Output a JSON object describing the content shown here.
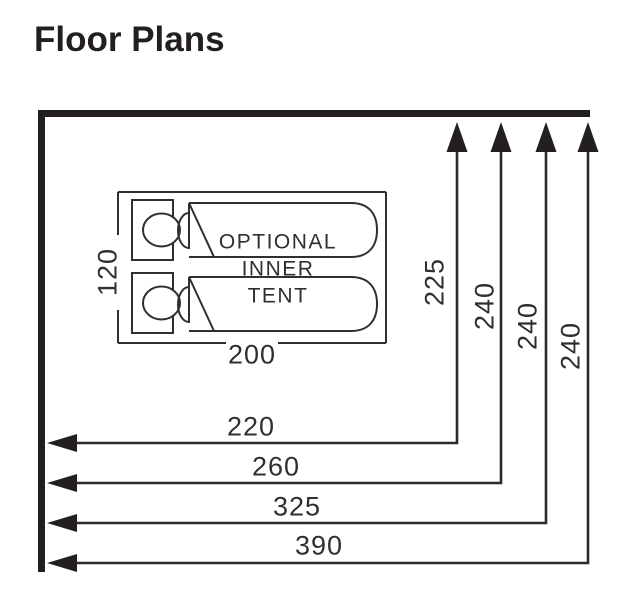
{
  "title": "Floor Plans",
  "colors": {
    "ink": "#231f20",
    "line": "#2f2f2f"
  },
  "inner_tent": {
    "label_lines": [
      "OPTIONAL",
      "INNER",
      "TENT"
    ],
    "width_label": "200",
    "depth_label": "120"
  },
  "dims": {
    "vertical": [
      "225",
      "240",
      "240",
      "240"
    ],
    "horizontal": [
      "220",
      "260",
      "325",
      "390"
    ]
  }
}
